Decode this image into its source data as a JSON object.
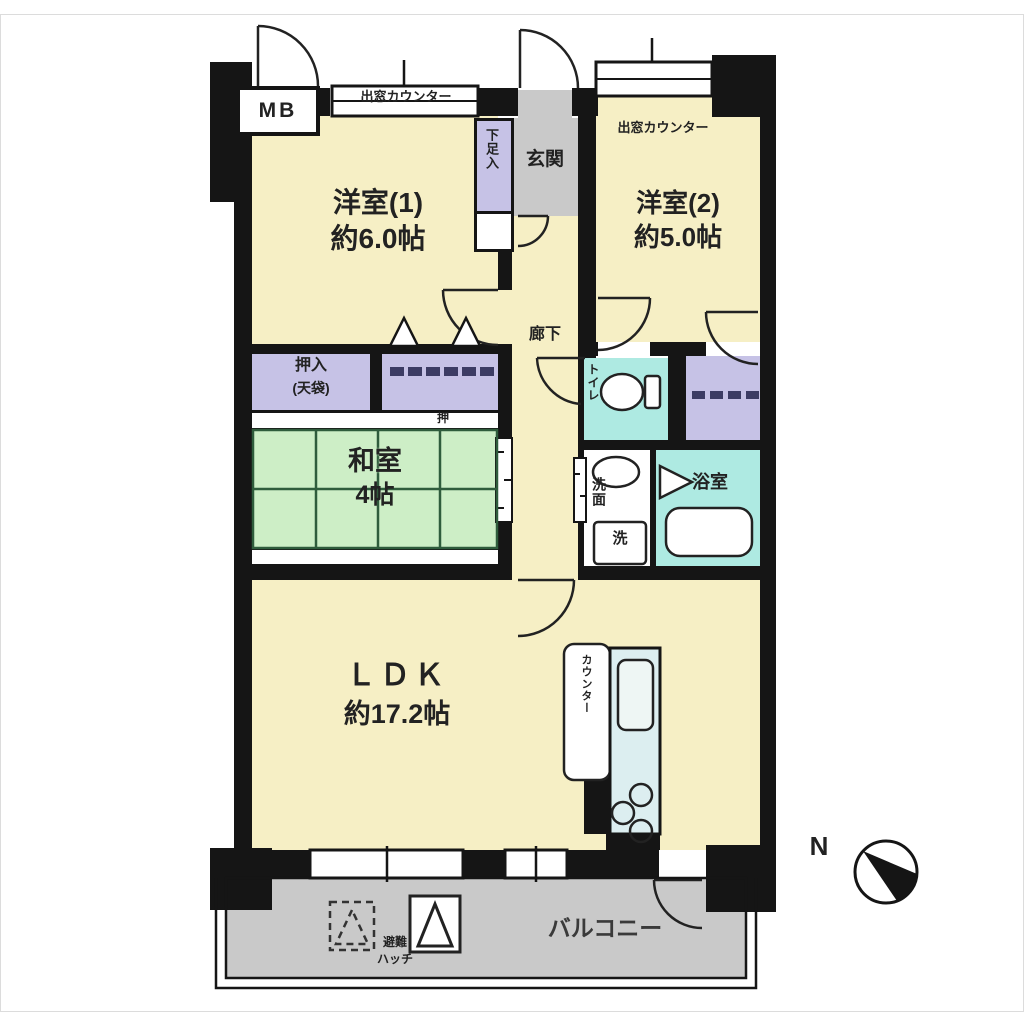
{
  "plan": {
    "rooms": {
      "western1": {
        "name": "洋室(1)",
        "size": "約6.0帖"
      },
      "western2": {
        "name": "洋室(2)",
        "size": "約5.0帖"
      },
      "japanese": {
        "name": "和室",
        "size": "4帖"
      },
      "ldk": {
        "name": "ＬＤＫ",
        "size": "約17.2帖"
      },
      "entrance": {
        "label": "玄関"
      },
      "hallway": {
        "label": "廊下"
      },
      "toilet": {
        "label": "トイレ"
      },
      "washroom": {
        "label": "洗面",
        "washer": "洗"
      },
      "bathroom": {
        "label": "浴室"
      },
      "balcony": {
        "label": "バルコニー"
      }
    },
    "storage": {
      "oshiire_line1": "押入",
      "oshiire_line2": "(天袋)",
      "closet_marker": "押",
      "shoe_box": "下足入"
    },
    "fixtures": {
      "meter_box": "MB",
      "bay_counter_1": "出窓カウンター",
      "bay_counter_2": "出窓カウンター",
      "kitchen_counter": "カウンター",
      "escape_hatch_line1": "避難",
      "escape_hatch_line2": "ハッチ"
    },
    "compass": {
      "north": "N"
    },
    "colors": {
      "wall": "#151515",
      "room_cream": "#f6efc5",
      "tatami_green": "#cdeec6",
      "closet_purple": "#c6c2e6",
      "wet_area_cyan": "#aeeae2",
      "entrance_gray": "#c9c9c9",
      "kitchen_blue": "#dceef0"
    }
  }
}
